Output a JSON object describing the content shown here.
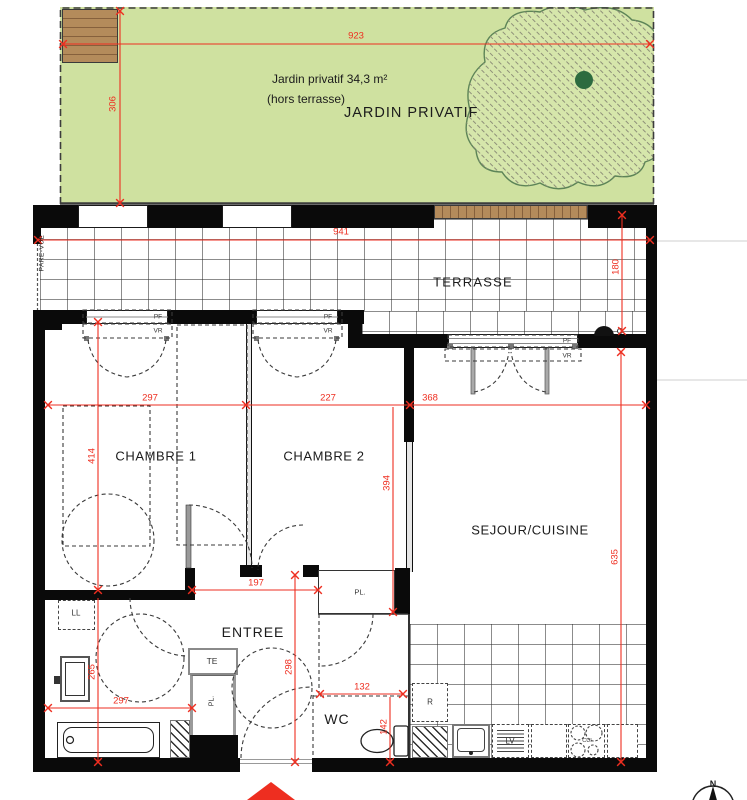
{
  "garden": {
    "area_label": "Jardin privatif 34,3 m²",
    "note": "(hors terrasse)",
    "name": "JARDIN PRIVATIF",
    "dim_w": "923",
    "dim_h": "306"
  },
  "terrace": {
    "name": "TERRASSE",
    "dim_w": "941",
    "dim_h": "180",
    "screen": "PARE-VUE"
  },
  "rooms": {
    "bedroom1": "CHAMBRE 1",
    "bedroom2": "CHAMBRE 2",
    "living": "SEJOUR/CUISINE",
    "entry": "ENTREE",
    "wc": "WC"
  },
  "dims": {
    "bedroom1_w": "297",
    "bedroom2_w": "227",
    "living_w": "368",
    "bedroom1_h": "414",
    "bedroom2_h": "394",
    "living_h": "635",
    "entry_w": "197",
    "entry_h": "298",
    "wc_w": "132",
    "wc_h": "142",
    "bath_w": "297",
    "bath_h": "265"
  },
  "tags": {
    "window": "PF",
    "shutter": "VR",
    "closet": "PL.",
    "washer": "LL",
    "elec": "TE",
    "fridge": "R",
    "dishwasher": "LV",
    "cooktop": "CUI",
    "north": "N"
  },
  "colors": {
    "garden": "#cfe1a0",
    "wood": "#b48b5b",
    "dimension": "#ee2e20",
    "wall": "#0a0a0a",
    "tree_dot": "#2d6b3f"
  }
}
